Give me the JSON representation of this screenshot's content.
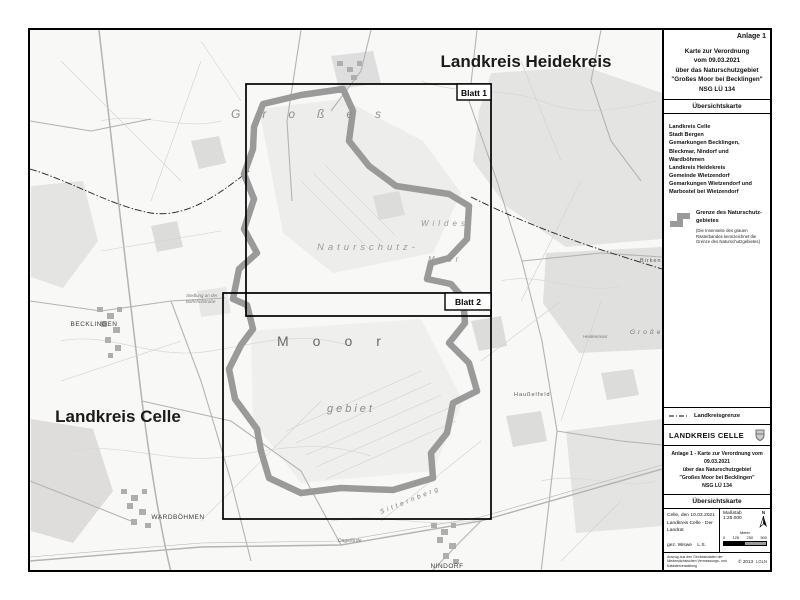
{
  "map": {
    "region_labels": {
      "heidekreis": "Landkreis Heidekreis",
      "celle": "Landkreis Celle"
    },
    "sheet_frames": {
      "blatt1": "Blatt 1",
      "blatt2": "Blatt 2"
    },
    "toponyms": {
      "grosses_top": "Großes",
      "naturschutz": "Naturschutz-",
      "wildes": "Wildes",
      "moor_small": "Moor",
      "moor_big": "Moor",
      "gebiet": "gebiet",
      "becklingen": "BECKLINGEN",
      "wardboehmen": "WARDBÖHMEN",
      "nindorf": "NINDORF",
      "dagefoerde": "Dageförde",
      "sitternberg": "Sitternberg",
      "hausselfeld": "Haußelfeld",
      "heidenmoor": "Heidenmoor",
      "birken": "Birken",
      "grosses_right": "Großes",
      "siedlung_1": "Siedlung an der",
      "siedlung_2": "Bahnhofstraße"
    }
  },
  "panel": {
    "anlage": "Anlage 1",
    "title_lines": {
      "l1": "Karte zur Verordnung",
      "l2": "vom 09.03.2021",
      "l3": "über das Naturschutzgebiet",
      "l4": "\"Großes Moor bei Becklingen\"",
      "l5": "NSG LÜ 134"
    },
    "section_title": "Übersichtskarte",
    "jurisdictions": {
      "l1": "Landkreis Celle",
      "l2": "Stadt Bergen",
      "l3": "Gemarkungen Becklingen,",
      "l4": "Bleckmar, Nindorf und Wardböhmen",
      "l5": "Landkreis Heidekreis",
      "l6": "Gemeinde Wietzendorf",
      "l7": "Gemarkungen Wietzendorf und",
      "l8": "Marbostel bei Wietzendorf"
    },
    "legend": {
      "boundary_label_1": "Grenze des Naturschutz-",
      "boundary_label_2": "gebietes",
      "boundary_note": "(Die Innenseite des grauen Rasterbandes kennzeichnet die Grenze des Naturschutzgebietes)",
      "district_boundary_label": "Landkreisgrenze"
    },
    "authority": "LANDKREIS CELLE",
    "title_block": {
      "l1": "Anlage 1 - Karte zur Verordnung vom 09.03.2021",
      "l2": "über das Naturschutzgebiet",
      "l3": "\"Großes Moor bei Becklingen\"",
      "l4": "NSG LÜ 134"
    },
    "section_title2": "Übersichtskarte",
    "imprint": {
      "date_place": "Celle, den 10.03.2021",
      "office": "Landkreis Celle - Der Landrat",
      "signature": "gez. Wiswe",
      "ls": "L.S.",
      "scale": "Maßstab 1:25.000",
      "north": "N",
      "scalebar_unit": "Meter",
      "tick0": "0",
      "tick1": "125",
      "tick2": "250",
      "tick3": "500",
      "copyright_1": "Auszug aus den Geobasisdaten der",
      "copyright_2": "Niedersächsischen Vermessungs- und Katasterverwaltung",
      "year": "© 2013",
      "agency": "LGLN"
    }
  },
  "colors": {
    "nsg_boundary_band": "#9a9a9a",
    "frame_black": "#000000",
    "map_background": "#f8f8f7",
    "forest_patch": "#e4e4e2",
    "map_label_gray": "#8f8f8f"
  }
}
